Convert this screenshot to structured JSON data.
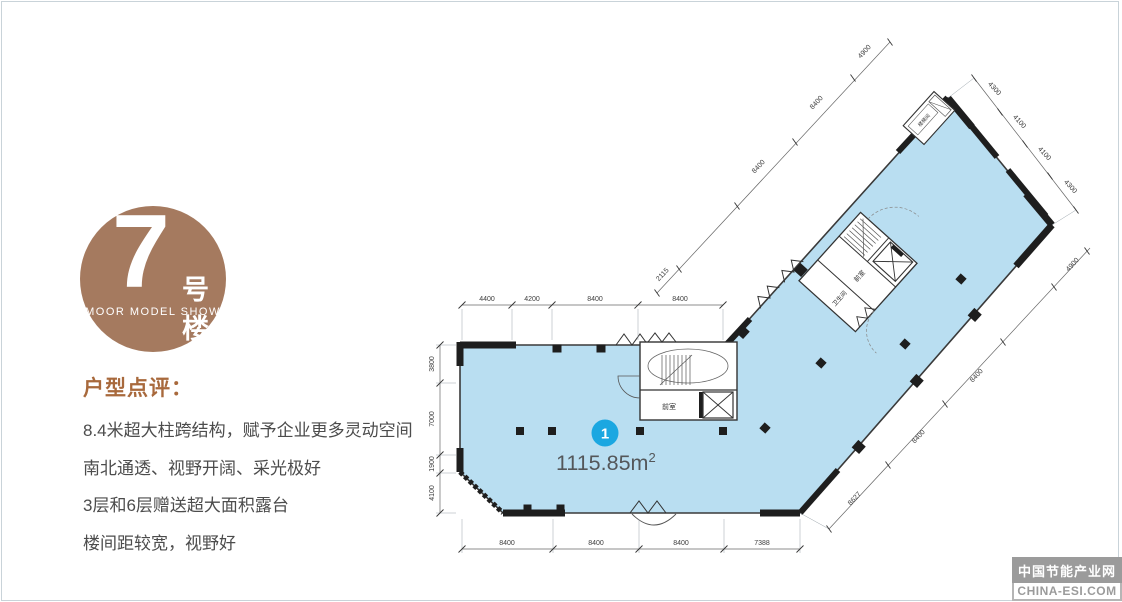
{
  "badge": {
    "number": "7",
    "suffix": "号楼",
    "subtitle": "MOOR MODEL SHOW",
    "bg_color": "#a57a5f"
  },
  "review": {
    "heading": "户型点评：",
    "heading_color": "#a8693c",
    "lines": [
      "8.4米超大柱跨结构，赋予企业更多灵动空间",
      "南北通透、视野开阔、采光极好",
      "3层和6层赠送超大面积露台",
      "楼间距较宽，视野好"
    ]
  },
  "plan": {
    "marker": {
      "number": "1",
      "area": "1115.85m",
      "area_sup": "2",
      "color": "#1ba7e1"
    },
    "rooms": {
      "lower_front": "前室",
      "upper_front": "前室",
      "toilet": "卫生间",
      "stair": "楼梯间"
    },
    "dims": {
      "top": [
        "4400",
        "4200",
        "8400",
        "8400"
      ],
      "left": [
        "3800",
        "7000",
        "1900",
        "4100"
      ],
      "bottom": [
        "8400",
        "8400",
        "8400",
        "7388"
      ],
      "upper_diag": [
        "2115",
        "8400",
        "8400",
        "4900"
      ],
      "top_right": [
        "4300",
        "4100",
        "4100",
        "4300"
      ],
      "lower_right": [
        "8627",
        "8400",
        "8400",
        "4900"
      ]
    },
    "colors": {
      "floor": "#b9def1",
      "wall": "#262626"
    }
  },
  "watermark": {
    "line1": "中国节能产业网",
    "line2": "CHINA-ESI.COM"
  }
}
